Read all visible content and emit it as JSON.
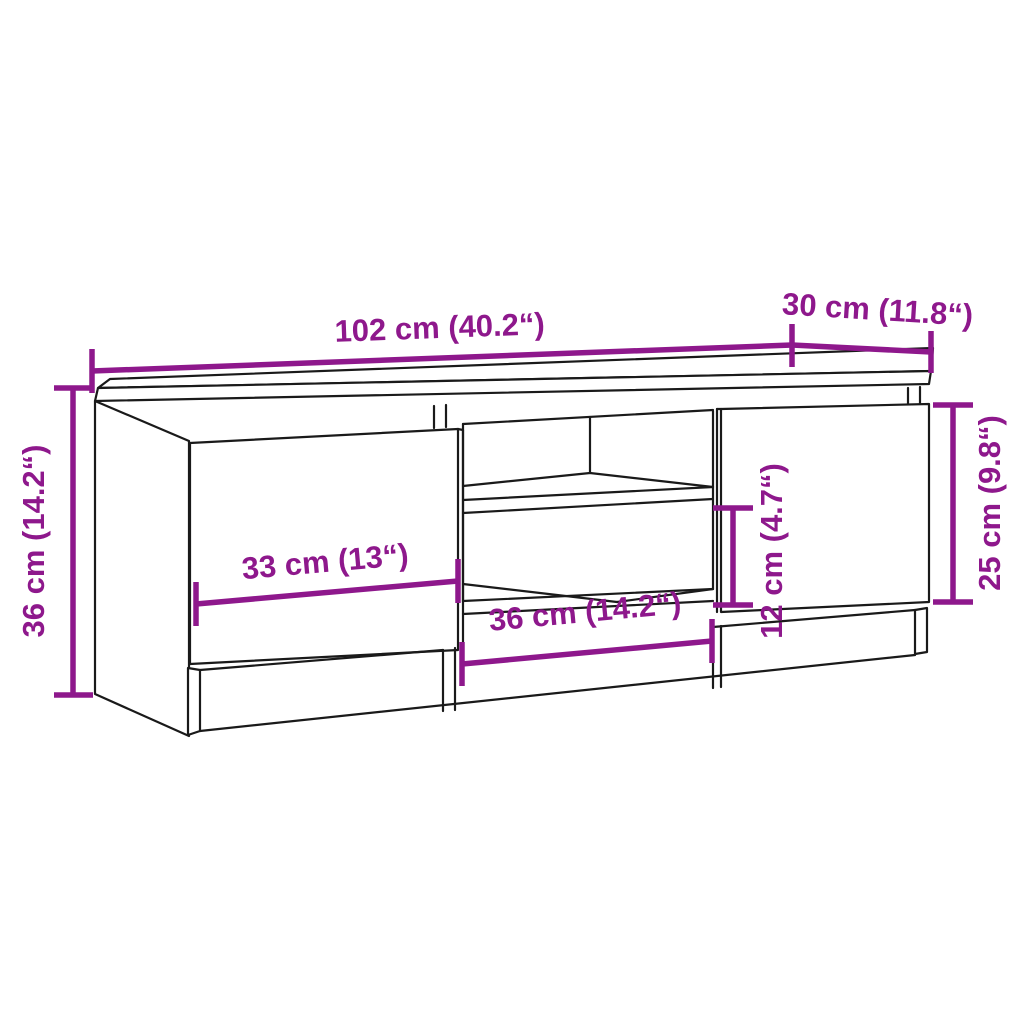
{
  "diagram": {
    "kind": "furniture-dimension-diagram",
    "subject": "TV cabinet with two doors, open middle compartment with shelf and plinth base",
    "background_color": "#ffffff",
    "outline_color": "#1a1a1a",
    "accent_color": "#8E188C",
    "labels": {
      "overall_width": "102 cm (40.2“)",
      "depth": "30 cm (11.8“)",
      "overall_height": "36 cm (14.2“)",
      "left_door_width": "33 cm (13“)",
      "middle_width": "36 cm (14.2“)",
      "shelf_gap_height": "12 cm (4.7“)",
      "right_door_height": "25 cm (9.8“)"
    },
    "annotations": [
      {
        "id": "overall-width",
        "text": "102 cm (40.2“)",
        "orientation": "horizontal",
        "position": "top"
      },
      {
        "id": "depth",
        "text": "30 cm (11.8“)",
        "orientation": "horizontal",
        "position": "top-right"
      },
      {
        "id": "overall-height",
        "text": "36 cm (14.2“)",
        "orientation": "vertical",
        "position": "left"
      },
      {
        "id": "left-door-width",
        "text": "33 cm (13“)",
        "orientation": "horizontal",
        "position": "on-left-door"
      },
      {
        "id": "middle-width",
        "text": "36 cm (14.2“)",
        "orientation": "horizontal",
        "position": "below-middle-compartment"
      },
      {
        "id": "shelf-gap-height",
        "text": "12 cm (4.7“)",
        "orientation": "vertical",
        "position": "middle-right"
      },
      {
        "id": "right-door-height",
        "text": "25 cm (9.8“)",
        "orientation": "vertical",
        "position": "right"
      }
    ]
  }
}
